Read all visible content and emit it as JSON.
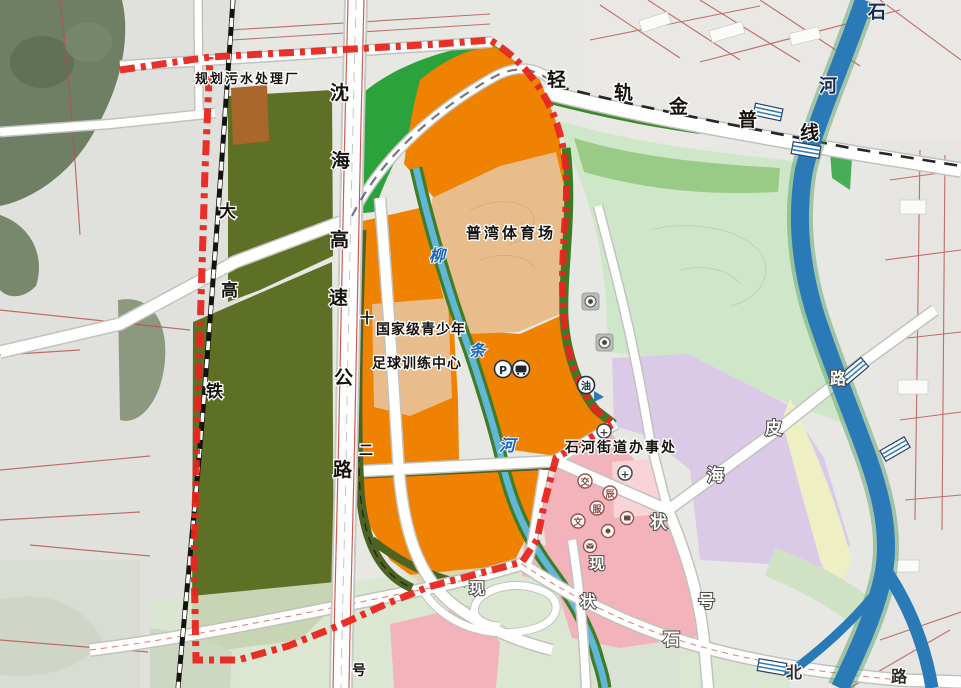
{
  "map": {
    "labels": [
      {
        "text": "规划污水处理厂",
        "x": 195,
        "y": 83,
        "style": "bh",
        "size": 13,
        "ls": 2
      },
      {
        "text": "普湾体育场",
        "x": 466,
        "y": 238,
        "style": "bh",
        "size": 15,
        "ls": 3
      },
      {
        "text": "国家级青少年",
        "x": 376,
        "y": 334,
        "style": "bh",
        "size": 14,
        "ls": 1
      },
      {
        "text": "足球训练中心",
        "x": 372,
        "y": 368,
        "style": "bh",
        "size": 14,
        "ls": 1
      },
      {
        "text": "石河街道办事处",
        "x": 565,
        "y": 452,
        "style": "bh",
        "size": 14,
        "ls": 2
      },
      {
        "text": "沈",
        "x": 330,
        "y": 99,
        "style": "bh",
        "size": 19
      },
      {
        "text": "海",
        "x": 331,
        "y": 167,
        "style": "bh",
        "size": 19
      },
      {
        "text": "高",
        "x": 330,
        "y": 246,
        "style": "bh",
        "size": 19
      },
      {
        "text": "速",
        "x": 329,
        "y": 304,
        "style": "bh",
        "size": 19
      },
      {
        "text": "公",
        "x": 334,
        "y": 384,
        "style": "bh",
        "size": 19
      },
      {
        "text": "路",
        "x": 333,
        "y": 476,
        "style": "bh",
        "size": 19
      },
      {
        "text": "大",
        "x": 219,
        "y": 217,
        "style": "bh",
        "size": 17
      },
      {
        "text": "高",
        "x": 221,
        "y": 296,
        "style": "bh",
        "size": 17
      },
      {
        "text": "铁",
        "x": 206,
        "y": 397,
        "style": "bh",
        "size": 17
      },
      {
        "text": "轻",
        "x": 547,
        "y": 86,
        "style": "bh",
        "size": 19
      },
      {
        "text": "轨",
        "x": 614,
        "y": 99,
        "style": "bh",
        "size": 19
      },
      {
        "text": "金",
        "x": 669,
        "y": 113,
        "style": "bh",
        "size": 19
      },
      {
        "text": "普",
        "x": 738,
        "y": 126,
        "style": "bh",
        "size": 19
      },
      {
        "text": "线",
        "x": 800,
        "y": 139,
        "style": "bh",
        "size": 19
      },
      {
        "text": "石",
        "x": 868,
        "y": 18,
        "style": "nb",
        "size": 18
      },
      {
        "text": "河",
        "x": 819,
        "y": 92,
        "style": "nb",
        "size": 18
      },
      {
        "text": "柳",
        "x": 429,
        "y": 261,
        "style": "bc",
        "size": 16
      },
      {
        "text": "条",
        "x": 469,
        "y": 356,
        "style": "bc",
        "size": 16
      },
      {
        "text": "河",
        "x": 499,
        "y": 451,
        "style": "bc",
        "size": 16
      },
      {
        "text": "十",
        "x": 360,
        "y": 323,
        "style": "bh",
        "size": 14
      },
      {
        "text": "二",
        "x": 359,
        "y": 455,
        "style": "bh",
        "size": 14
      },
      {
        "text": "号",
        "x": 352,
        "y": 675,
        "style": "bh",
        "size": 14
      },
      {
        "text": "现",
        "x": 589,
        "y": 569,
        "style": "wo",
        "size": 16
      },
      {
        "text": "状",
        "x": 580,
        "y": 607,
        "style": "wo",
        "size": 16
      },
      {
        "text": "现",
        "x": 469,
        "y": 594,
        "style": "wo",
        "size": 16
      },
      {
        "text": "皮",
        "x": 765,
        "y": 434,
        "style": "wo",
        "size": 17
      },
      {
        "text": "海",
        "x": 707,
        "y": 481,
        "style": "wo",
        "size": 17
      },
      {
        "text": "状",
        "x": 650,
        "y": 528,
        "style": "wo",
        "size": 17
      },
      {
        "text": "号",
        "x": 698,
        "y": 607,
        "style": "wo",
        "size": 17
      },
      {
        "text": "石",
        "x": 663,
        "y": 645,
        "style": "wo",
        "size": 17
      },
      {
        "text": "北",
        "x": 786,
        "y": 678,
        "style": "dh",
        "size": 16
      },
      {
        "text": "路",
        "x": 891,
        "y": 682,
        "style": "dh",
        "size": 16
      },
      {
        "text": "路",
        "x": 830,
        "y": 384,
        "style": "wo",
        "size": 16
      }
    ],
    "icons": {
      "parking_glyph": "P",
      "gas_glyph": "油",
      "clinic_glyph": "+",
      "hospital_glyph": "+",
      "service_glyphs": [
        "交",
        "辰",
        "服",
        "文"
      ]
    },
    "colors": {
      "boundary_red": "#e8251d",
      "orange": "#ef8200",
      "olive_green": "#5d7026",
      "bright_green": "#2ba23c",
      "mint_green": "#cfe7c9",
      "medium_green": "#94c87e",
      "purple": "#dbc9e8",
      "pink": "#f3b3ba",
      "tan": "#e9bd8b",
      "pale_yellow": "#efefc4",
      "river_blue": "#2a7ab8",
      "stream_blue": "#62b7d9",
      "brown_building": "#a9672b"
    }
  }
}
